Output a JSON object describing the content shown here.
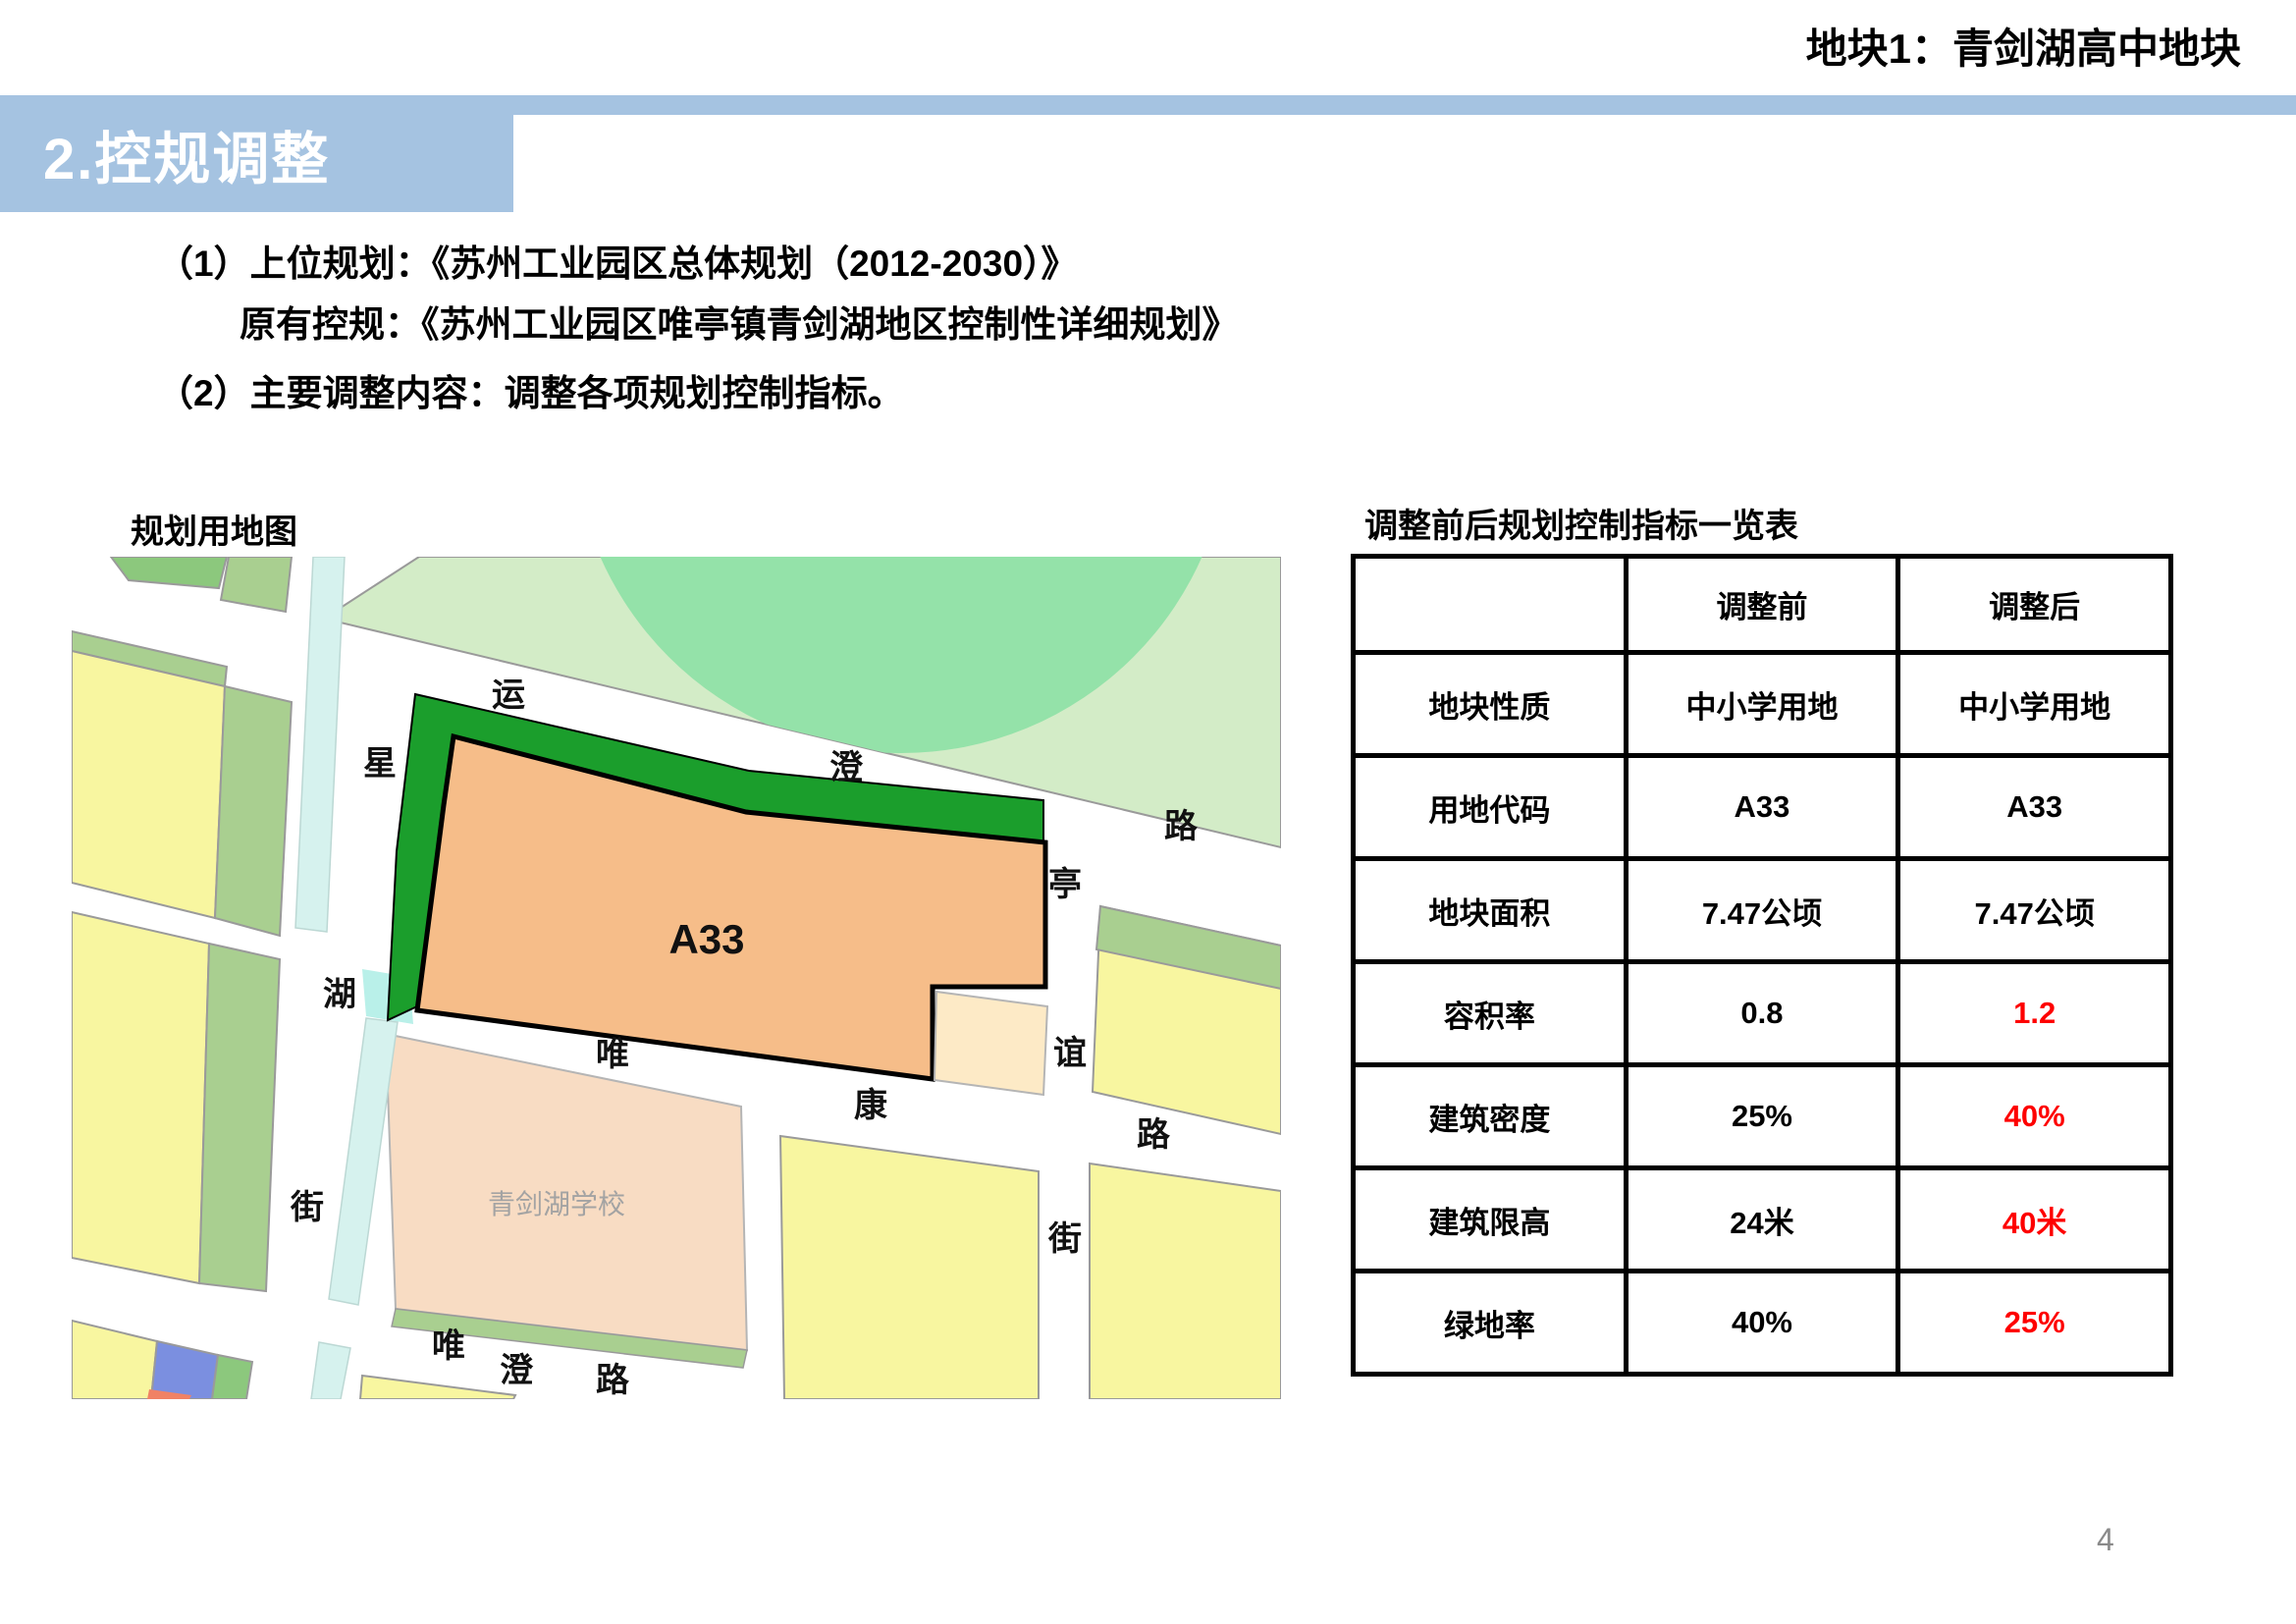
{
  "header": {
    "plot_tag": "地块1：青剑湖高中地块",
    "section_title": "2.控规调整"
  },
  "body": {
    "line1": "（1）上位规划：《苏州工业园区总体规划（2012-2030）》",
    "line2": "原有控规：《苏州工业园区唯亭镇青剑湖地区控制性详细规划》",
    "line3": "（2）主要调整内容：调整各项规划控制指标。"
  },
  "map": {
    "title": "规划用地图",
    "plot_code": "A33",
    "school_label": "青剑湖学校",
    "roads": {
      "yuncheng": [
        "运",
        "澄",
        "路"
      ],
      "xinghu": [
        "星",
        "湖",
        "街"
      ],
      "tingyi": [
        "亭",
        "谊",
        "街"
      ],
      "weikang": [
        "唯",
        "康",
        "路"
      ],
      "weicheng": [
        "唯",
        "澄",
        "路"
      ]
    },
    "colors": {
      "park": "#d3ecc7",
      "park_circle": "#94e2a9",
      "dark_green": "#1b9e2c",
      "plot_orange": "#f6bd89",
      "notch_cream": "#fdeac6",
      "school_peach": "#f8dcc3",
      "parcel_yellow": "#f8f6a0",
      "sage_green": "#a9cf90",
      "bright_green": "#8cc87d",
      "canal_cyan": "#d6f2ee",
      "canal_bright": "#b9f0e9",
      "parcel_blue": "#7b8fe0",
      "parcel_red": "#f08265"
    }
  },
  "table": {
    "title": "调整前后规划控制指标一览表",
    "columns": {
      "before": "调整前",
      "after": "调整后"
    },
    "rows": [
      {
        "label": "地块性质",
        "before": "中小学用地",
        "after": "中小学用地",
        "after_changed": false
      },
      {
        "label": "用地代码",
        "before": "A33",
        "after": "A33",
        "after_changed": false
      },
      {
        "label": "地块面积",
        "before": "7.47公顷",
        "after": "7.47公顷",
        "after_changed": false
      },
      {
        "label": "容积率",
        "before": "0.8",
        "after": "1.2",
        "after_changed": true
      },
      {
        "label": "建筑密度",
        "before": "25%",
        "after": "40%",
        "after_changed": true
      },
      {
        "label": "建筑限高",
        "before": "24米",
        "after": "40米",
        "after_changed": true
      },
      {
        "label": "绿地率",
        "before": "40%",
        "after": "25%",
        "after_changed": true
      }
    ]
  },
  "slide": {
    "page_number": "4"
  },
  "colors": {
    "accent_blue": "#a5c3e1",
    "changed_red": "#fe0000",
    "page_number_gray": "#8a8a8a"
  }
}
